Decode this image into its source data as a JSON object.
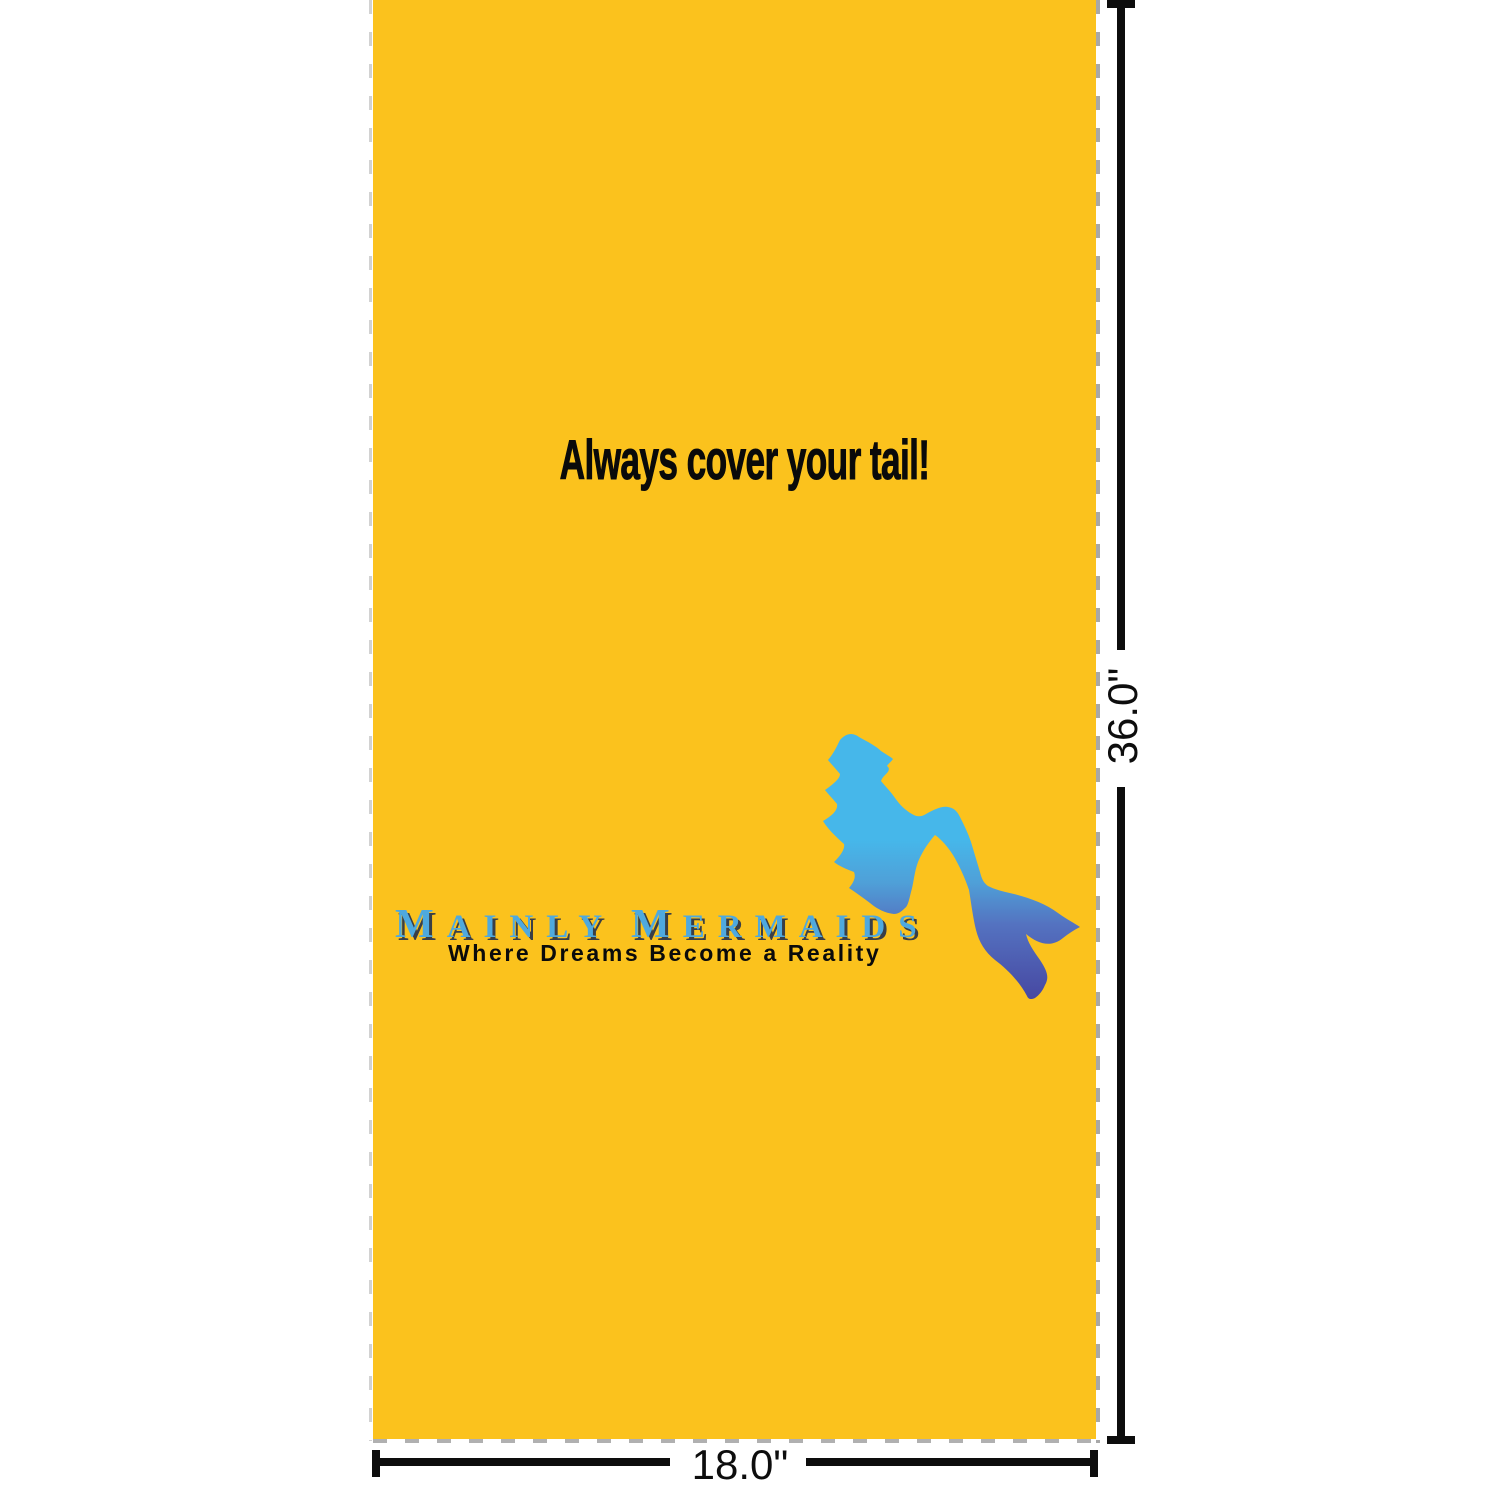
{
  "towel": {
    "background_color": "#FBC21D",
    "message": "Always cover your tail!",
    "message_color": "#0A0A0A",
    "logo": {
      "words": [
        {
          "lead": "M",
          "rest": "AINLY"
        },
        {
          "lead": "M",
          "rest": "ERMAIDS"
        }
      ],
      "color": "#4FA9DE",
      "shadow_color": "#3A3F46",
      "tagline": "Where Dreams Become a Reality",
      "tagline_color": "#0B0B0B"
    },
    "mermaid": {
      "description": "mermaid-silhouette",
      "gradient_stops": [
        {
          "offset": "0%",
          "color": "#46B7EA"
        },
        {
          "offset": "40%",
          "color": "#46B7EA"
        },
        {
          "offset": "56%",
          "color": "#4FA0D8"
        },
        {
          "offset": "72%",
          "color": "#5472C0"
        },
        {
          "offset": "100%",
          "color": "#4748A2"
        }
      ]
    }
  },
  "dimensions": {
    "height_label": "36.0\"",
    "width_label": "18.0\"",
    "line_color": "#0D0D0D"
  }
}
